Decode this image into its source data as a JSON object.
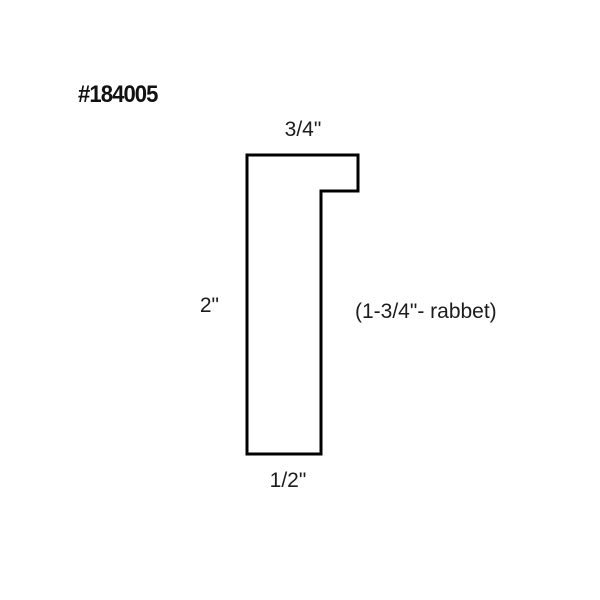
{
  "page": {
    "background_color": "#ffffff"
  },
  "part_number": "#184005",
  "diagram": {
    "type": "moulding-profile-cross-section",
    "stroke_color": "#000000",
    "fill_color": "#ffffff",
    "stroke_width": 3,
    "profile_points": [
      [
        247,
        155
      ],
      [
        358,
        155
      ],
      [
        358,
        191
      ],
      [
        321,
        191
      ],
      [
        321,
        454
      ],
      [
        247,
        454
      ]
    ],
    "labels": {
      "top_width": "3/4\"",
      "overall_height": "2\"",
      "rabbet": "(1-3/4\"- rabbet)",
      "bottom_width": "1/2\""
    }
  }
}
